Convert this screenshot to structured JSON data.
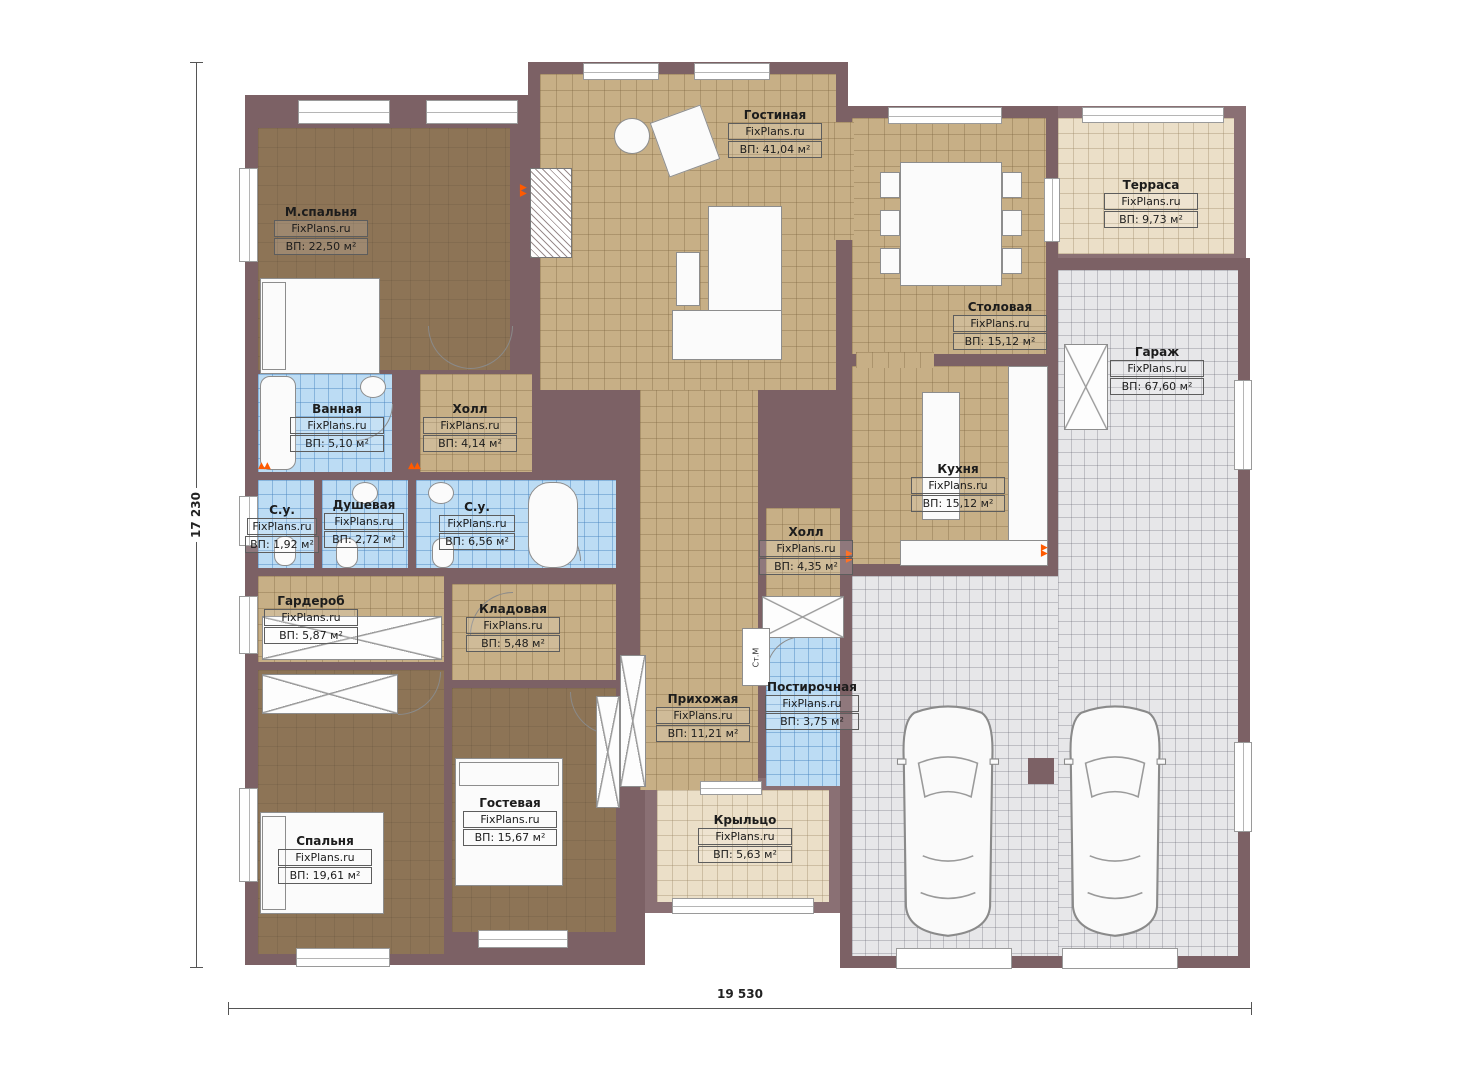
{
  "plan": {
    "watermark": "FixPlans.ru",
    "washing_machine_label": "Ст.М",
    "dimensions": {
      "width_label": "19 530",
      "height_label": "17 230"
    },
    "colors": {
      "wall": "#7c6165",
      "wood_floor": "#8d7456",
      "tile_floor": "#c7af86",
      "wet_floor": "#bcdcf4",
      "garage_floor": "#e7e7e9",
      "terrace_floor": "#ebdfc8",
      "radiator_accent": "#ff5a00"
    }
  },
  "rooms": [
    {
      "name": "Гостиная",
      "area": "ВП: 41,04 м²"
    },
    {
      "name": "М.спальня",
      "area": "ВП: 22,50 м²"
    },
    {
      "name": "Терраса",
      "area": "ВП: 9,73 м²"
    },
    {
      "name": "Столовая",
      "area": "ВП: 15,12 м²"
    },
    {
      "name": "Гараж",
      "area": "ВП: 67,60 м²"
    },
    {
      "name": "Ванная",
      "area": "ВП: 5,10 м²"
    },
    {
      "name": "Холл",
      "area": "ВП: 4,14 м²"
    },
    {
      "name": "С.у.",
      "area": "ВП: 1,92 м²"
    },
    {
      "name": "Душевая",
      "area": "ВП: 2,72 м²"
    },
    {
      "name": "С.у.",
      "area": "ВП: 6,56 м²"
    },
    {
      "name": "Кухня",
      "area": "ВП: 15,12 м²"
    },
    {
      "name": "Холл",
      "area": "ВП: 4,35 м²"
    },
    {
      "name": "Гардероб",
      "area": "ВП: 5,87 м²"
    },
    {
      "name": "Кладовая",
      "area": "ВП: 5,48 м²"
    },
    {
      "name": "Прихожая",
      "area": "ВП: 11,21 м²"
    },
    {
      "name": "Постирочная",
      "area": "ВП: 3,75 м²"
    },
    {
      "name": "Гостевая",
      "area": "ВП: 15,67 м²"
    },
    {
      "name": "Спальня",
      "area": "ВП: 19,61 м²"
    },
    {
      "name": "Крыльцо",
      "area": "ВП: 5,63 м²"
    }
  ]
}
